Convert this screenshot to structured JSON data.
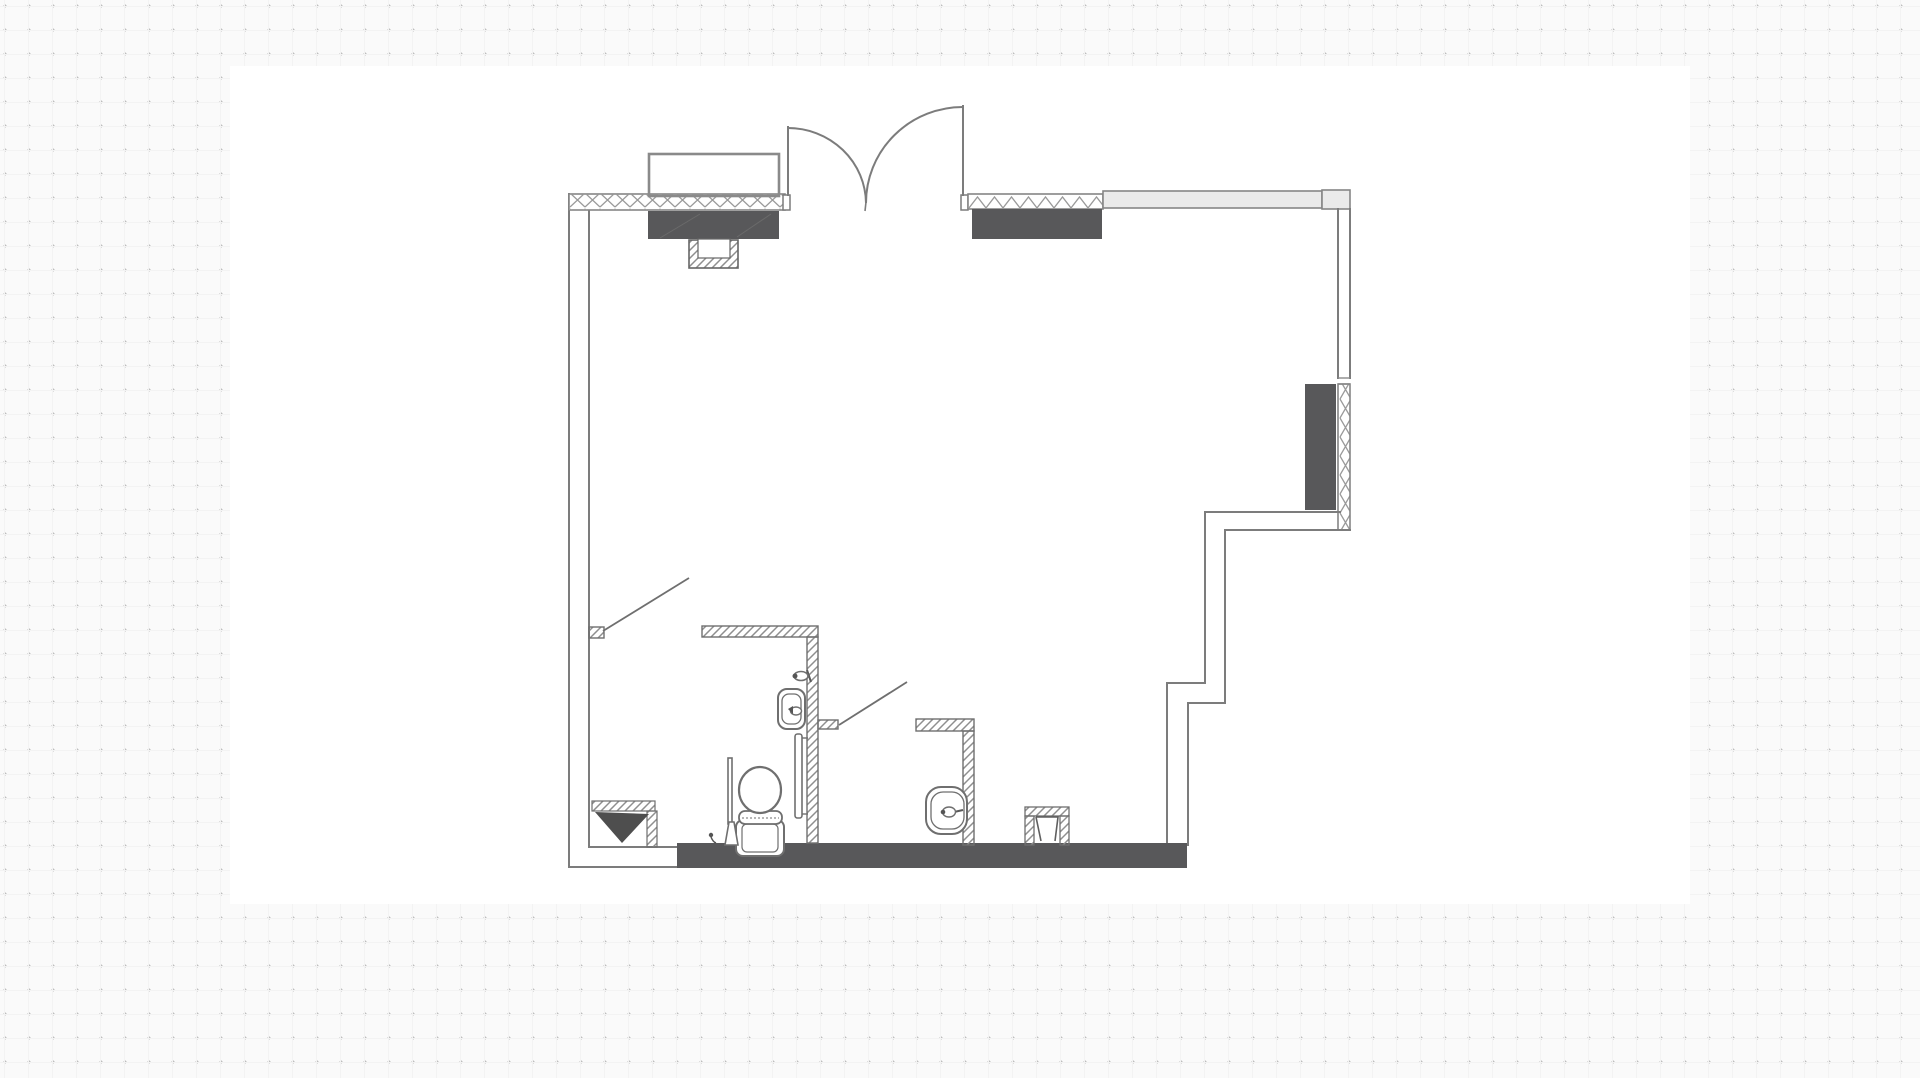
{
  "app": {
    "kind": "drawing-canvas",
    "visible_text": [],
    "description": "Hand-drawn style architectural floor plan of a studio unit with two small bathrooms, drawn on a white artboard over a dotted grid canvas"
  },
  "canvas": {
    "background_color": "#fafafa",
    "dot_color": "#bdbdbd",
    "dot_pitch_px": 24,
    "artboard": {
      "x": 230,
      "y": 66,
      "width": 1460,
      "height": 838,
      "color": "#ffffff"
    }
  },
  "floor_plan": {
    "stroke_color": "#7c7c7c",
    "hatch_color": "#9a9a9a",
    "interior_wall_hatch_color": "#8f8f8f",
    "dark_fill": "#58585a",
    "light_wall_fill": "#eaeaea",
    "dark_accent": "#4e4e4e",
    "elements": [
      "exterior-walls",
      "window-top-left",
      "balcony-outline",
      "lintel-top-left",
      "duct-top-left",
      "double-entry-door",
      "window-top-right",
      "lintel-top-right",
      "wall-band-top-right",
      "right-wall-window",
      "dark-panel-right",
      "stepped-wall-right",
      "bottom-wall",
      "bathroom-1-walls",
      "bathroom-2-walls",
      "toilet",
      "toilet-brush",
      "floor-hook",
      "sink-1",
      "towel-rail",
      "faucet-1",
      "sink-2",
      "stool-niche",
      "corner-shelf",
      "leader-line-1",
      "leader-line-2"
    ]
  }
}
